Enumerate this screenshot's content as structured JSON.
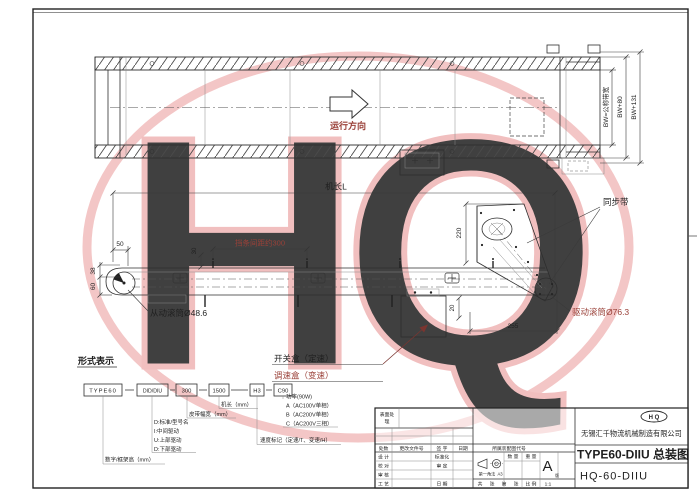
{
  "watermark": {
    "text": "HQ"
  },
  "top_view": {
    "direction": "运行方向",
    "bw": "BW=公称带宽",
    "bw80": "BW+80",
    "bw131": "BW+131"
  },
  "side_view": {
    "machine_length": "机长L",
    "d50": "50",
    "d30": "30",
    "d38": "38",
    "d60": "60",
    "baffle": "挡条间距约300",
    "d220": "220",
    "d20": "20",
    "d255": "255",
    "sync_belt": "同步带",
    "drive_roller": "驱动滚筒Ø76.3",
    "driven_roller": "从动滚筒Ø48.6",
    "switch_box": "开关盒（定速）",
    "speed_box": "调速盒（变速）"
  },
  "designation": {
    "heading": "形式表示",
    "boxes": [
      "TYPE60",
      "DID/DIU",
      "300",
      "1500",
      "H3",
      "C90"
    ],
    "frame_height": "数字/框架高（mm）",
    "drive_types": [
      "D:标准/型号名",
      "I:中间驱动",
      "U:上部驱动",
      "D:下部驱动"
    ],
    "belt_width": "皮带幅宽（mm）",
    "length": "机长（mm）",
    "speed_mark": "速度标记（定速/T、变速/H）",
    "power": [
      "功率(90W)",
      "A（AC100V单相）",
      "B（AC200V单相）",
      "C（AC200V三相）"
    ]
  },
  "title_block": {
    "surface_1": "表面处",
    "surface_2": "理",
    "changes": "处数",
    "change_file": "更改文件号",
    "sign": "签 字",
    "date": "日期",
    "row_design": "设 计",
    "row_check": "校 对",
    "row_audit": "审 核",
    "row_process": "工 艺",
    "std": "标准化",
    "approve": "审 定",
    "date2": "日 期",
    "belongs": "所属装配图代号",
    "projection": "第一角法",
    "sheet_size": "A3",
    "qty": "数 量",
    "weight": "重 量",
    "rev": "A",
    "rev_small": "版",
    "total": "共",
    "sheet_unit": "张",
    "page": "第",
    "sheet_unit2": "张",
    "scale_label": "比 例",
    "scale": "1:1",
    "logo": "H Q",
    "company": "无锡汇千物流机械制造有限公司",
    "title": "TYPE60-DIIU 总装图",
    "drawing_no": "HQ-60-DIIU"
  }
}
